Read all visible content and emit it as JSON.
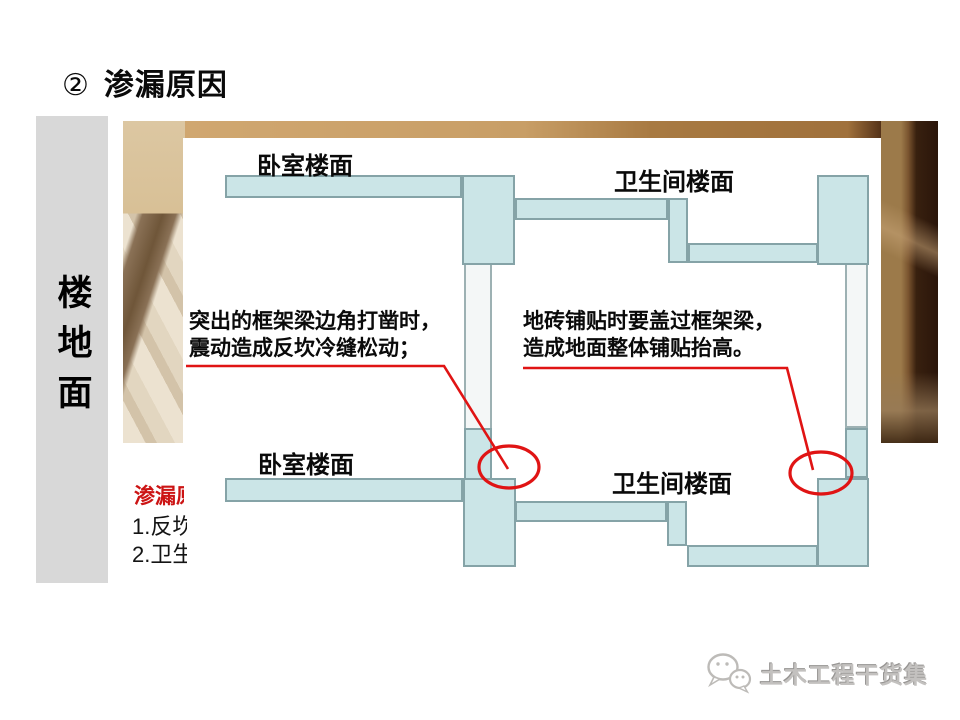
{
  "title": {
    "bullet": "②",
    "text": "渗漏原因"
  },
  "sidebar": {
    "label": "楼地面"
  },
  "diagram": {
    "upper": {
      "bedroom_label": "卧室楼面",
      "bathroom_label": "卫生间楼面"
    },
    "lower": {
      "bedroom_label": "卧室楼面",
      "bathroom_label": "卫生间楼面"
    },
    "annotations": {
      "left": {
        "line1": "突出的框架梁边角打凿时，",
        "line2": "震动造成反坎冷缝松动；"
      },
      "right": {
        "line1": "地砖铺贴时要盖过框架梁，",
        "line2": "造成地面整体铺贴抬高。"
      }
    },
    "colors": {
      "slab_fill": "#cbe5e7",
      "slab_border": "#85a3a7",
      "wall_fill": "#f4f7f7",
      "marker_red": "#e01414"
    }
  },
  "leak_notes": {
    "heading_clipped": "渗漏原",
    "item1_clipped": "1.反坎",
    "item2_clipped": "2.卫生"
  },
  "watermark": {
    "text": "土木工程干货集",
    "icon": "wechat-icon",
    "color": "#c3c1bf"
  },
  "sidebar_color": "#d8d8d8",
  "leak_heading_color": "#cc1414"
}
